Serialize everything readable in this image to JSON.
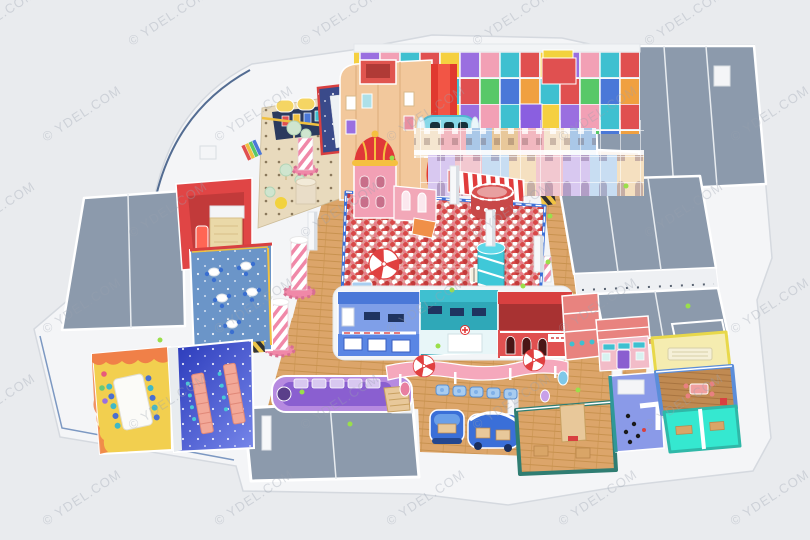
{
  "meta": {
    "title": "Indoor playground park — 3D isometric floor-plan rendering",
    "render_type": "3d-architectural-render",
    "canvas": {
      "width": 810,
      "height": 540
    },
    "background_color": "#e9ebee"
  },
  "watermark": {
    "text": "© YDEL.COM",
    "color": "#9aa2af",
    "opacity": 0.34,
    "angle_deg": -33,
    "font_size": 13
  },
  "palette": {
    "background": "#e9ebee",
    "outer_wall_white": "#f4f5f7",
    "roof_gray": "#8c9aac",
    "wood_floor": "#dca56a",
    "ball_pit_base": "#e0a29c",
    "ball_red": "#d94848",
    "slide_red": "#e0392f",
    "castle_pink": "#f2a0b5",
    "crown_red": "#e03838",
    "crown_gold": "#f5c040",
    "teal": "#3fc0d0",
    "royal_blue": "#4a78d8",
    "lavender_train": "#b68ae0",
    "party_yellow": "#f2cf4f",
    "party_orange_drip": "#f08048",
    "classroom_galaxy_blue": "#2636b8",
    "cyan_room": "#35e8d0",
    "awning_pink": "#f5a8bc",
    "hazard_yellow": "#f2c540",
    "lime_accent": "#9adf4a",
    "candy_stripe_pink": "#f088a8"
  },
  "areas": [
    {
      "id": "entry-plaza",
      "label": "entry plaza with dotted floor and mint trees",
      "color": "#e8dabd"
    },
    {
      "id": "claw-arcade",
      "label": "claw-machine arcade with yellow canopies",
      "color": "#f5d563"
    },
    {
      "id": "navy-climb-pit",
      "label": "navy climb pit with white slide",
      "color": "#3a4a8a"
    },
    {
      "id": "red-slide-room",
      "label": "red toddler slide room",
      "color": "#e04545"
    },
    {
      "id": "snow-cafe",
      "label": "snow cafe with round tables",
      "color": "#6b95c8"
    },
    {
      "id": "party-room",
      "label": "yellow birthday party room",
      "color": "#f2cf4f"
    },
    {
      "id": "classroom",
      "label": "galaxy-blue classroom with desk rows",
      "color": "#2636b8"
    },
    {
      "id": "train-room",
      "label": "lavender train-themed room",
      "color": "#b68ae0"
    },
    {
      "id": "play-structure",
      "label": "multi-level soft-play structure with steel grid",
      "color": "#f2c89c"
    },
    {
      "id": "giant-red-slide",
      "label": "giant red wave slide",
      "color": "#e0392f"
    },
    {
      "id": "crawl-tube",
      "label": "blue crawl tube with windows",
      "color": "#86d8e8"
    },
    {
      "id": "crown-castle",
      "label": "pink castle tower with red crown roof",
      "color": "#f2a0b5"
    },
    {
      "id": "townhouse-facades",
      "label": "pastel townhouse facade street",
      "color": "#f5e6d0"
    },
    {
      "id": "giant-ball-pit",
      "label": "giant ball pit",
      "color": "#e0a29c"
    },
    {
      "id": "carousel-umbrella",
      "label": "red-white carousel umbrella",
      "color": "#e04040"
    },
    {
      "id": "round-tower",
      "label": "round red arch tower",
      "color": "#d85050"
    },
    {
      "id": "spiral-tower",
      "label": "teal spiral slide tower",
      "color": "#3fc8d8"
    },
    {
      "id": "role-play-blue-shop",
      "label": "role-play blue supermarket",
      "color": "#4a78d8"
    },
    {
      "id": "role-play-clinic",
      "label": "role-play teal clinic counter",
      "color": "#3fc0d0"
    },
    {
      "id": "role-play-red-station",
      "label": "role-play red station with arch windows",
      "color": "#d84040"
    },
    {
      "id": "candy-awning",
      "label": "pink candy awning with kiddie cars",
      "color": "#f5a8bc"
    },
    {
      "id": "ride-units",
      "label": "blue kiddie ride machines",
      "color": "#3a6fd8"
    },
    {
      "id": "teal-room",
      "label": "green-teal room with wood floor",
      "color": "#2f7d72"
    },
    {
      "id": "dressing-room",
      "label": "periwinkle room with figures and counters",
      "color": "#8a9ae8"
    },
    {
      "id": "candy-house",
      "label": "candy shop house with teal awnings",
      "color": "#f2bcc8"
    },
    {
      "id": "yellow-room",
      "label": "yellow rest room with bench",
      "color": "#f5ecb0"
    },
    {
      "id": "blue-dining-room",
      "label": "blue room with wood floor and pink table",
      "color": "#5b8dd9"
    },
    {
      "id": "cyan-rooms",
      "label": "pair of cyan play rooms",
      "color": "#35e8d0"
    },
    {
      "id": "service-roofs",
      "label": "gray service / back-of-house roofs",
      "color": "#8c9aac"
    },
    {
      "id": "wood-walkways",
      "label": "wooden walkway floors",
      "color": "#dca56a"
    },
    {
      "id": "candy-columns",
      "label": "candy-striped columns with pink gear bases",
      "color": "#f088a8"
    }
  ]
}
